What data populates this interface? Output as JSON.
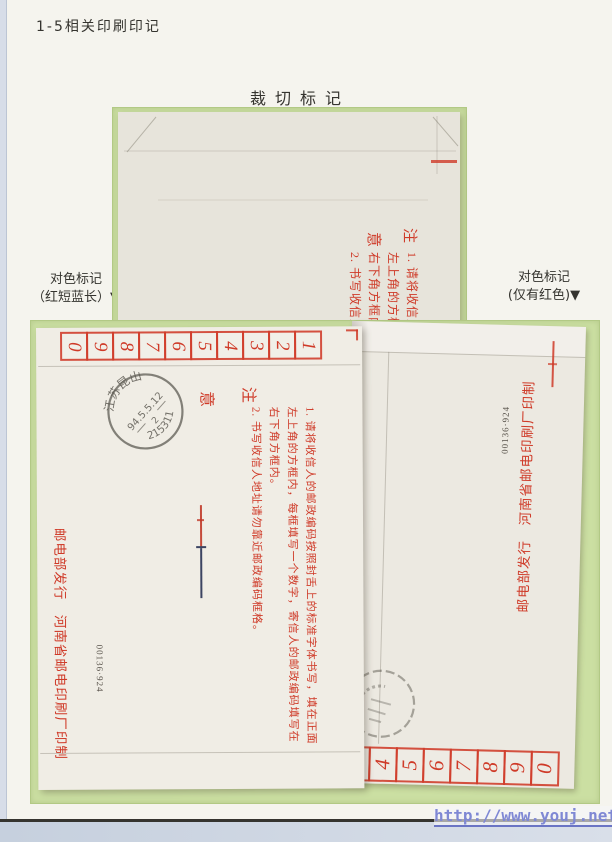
{
  "page": {
    "heading": "1-5相关印刷印记",
    "title": "裁切标记",
    "left_label": {
      "line1": "对色标记",
      "line2": "（红短蓝长）▼"
    },
    "right_label": {
      "line1": "对色标记",
      "line2": "(仅有红色)▼"
    },
    "watermark": "http://www.youj.net/"
  },
  "notes": {
    "heading_top": "注",
    "heading_bottom": "意",
    "item1_line1": "1. 请将收信人的邮政编码按照封舌上的标准字体书写，填在正面",
    "item1_line2": "左上角的方框内，每框填写一个数字，寄信人的邮政编码填写在",
    "item1_line3": "右下角方框内。",
    "item2": "2. 书写收信人地址请勿靠近邮政编码框格。"
  },
  "main_envelope": {
    "flap_digits": [
      "0",
      "9",
      "8",
      "7",
      "6",
      "5",
      "4",
      "3",
      "2",
      "1"
    ],
    "imprint": "邮电部发行　河南省邮电印刷厂印制",
    "serial": "00136·924",
    "postmark": {
      "region": "江苏昆山",
      "date": "94.5.5.12",
      "code": "2",
      "postcode": "215311"
    }
  },
  "right_envelope": {
    "flap_digits": [
      "3",
      "4",
      "5",
      "6",
      "7",
      "8",
      "9",
      "0"
    ],
    "imprint": "邮电部发行　河南省邮电印刷厂印制",
    "serial": "00136·924"
  },
  "colors": {
    "mat_green": "#cbdfa2",
    "print_red": "#cf3a28",
    "postmark_ink": "#4e4b43",
    "watermark_blue": "#7f88d4",
    "registration_blue": "#3c4462"
  }
}
